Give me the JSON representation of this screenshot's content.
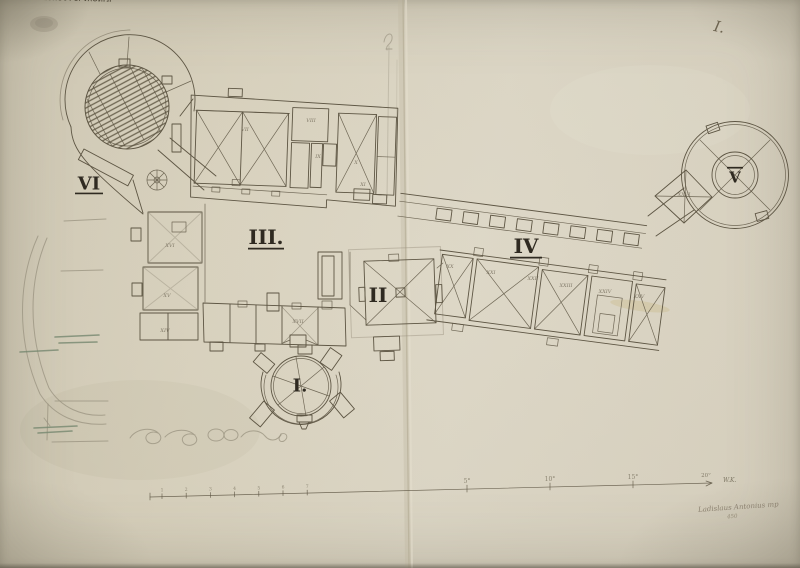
{
  "document": {
    "stamp_text": "HRVATSKOJ I SLAVONIJI",
    "plate_number": "I.",
    "signature": "Ladislaus Antonius mp",
    "signature_note": "450"
  },
  "plan": {
    "section_labels": [
      {
        "id": "I",
        "label": "I.",
        "x": 300,
        "y": 385,
        "size": 18,
        "bar": "none"
      },
      {
        "id": "II",
        "label": "II",
        "x": 378,
        "y": 295,
        "size": 20,
        "bar": "none"
      },
      {
        "id": "III",
        "label": "III.",
        "x": 266,
        "y": 237,
        "size": 20,
        "bar": "under",
        "bar_w": 18
      },
      {
        "id": "IV",
        "label": "IV",
        "x": 526,
        "y": 246,
        "size": 20,
        "bar": "under",
        "bar_w": 16
      },
      {
        "id": "V",
        "label": "V",
        "x": 735,
        "y": 177,
        "size": 15,
        "bar": "over",
        "bar_w": 8
      },
      {
        "id": "VI",
        "label": "VI",
        "x": 89,
        "y": 183,
        "size": 18,
        "bar": "under",
        "bar_w": 14
      }
    ],
    "room_labels": [
      {
        "label": "VII",
        "x": 245,
        "y": 131
      },
      {
        "label": "VIII",
        "x": 311,
        "y": 122
      },
      {
        "label": "IX",
        "x": 318,
        "y": 158
      },
      {
        "label": "X",
        "x": 356,
        "y": 164
      },
      {
        "label": "XI",
        "x": 363,
        "y": 186
      },
      {
        "label": "XIV",
        "x": 165,
        "y": 332
      },
      {
        "label": "XV",
        "x": 167,
        "y": 297
      },
      {
        "label": "XVI",
        "x": 170,
        "y": 247
      },
      {
        "label": "XVII",
        "x": 298,
        "y": 323
      },
      {
        "label": "XX",
        "x": 450,
        "y": 268
      },
      {
        "label": "XXI",
        "x": 491,
        "y": 274
      },
      {
        "label": "XXII",
        "x": 533,
        "y": 280
      },
      {
        "label": "XXIII",
        "x": 566,
        "y": 287
      },
      {
        "label": "XXIV",
        "x": 605,
        "y": 293
      },
      {
        "label": "XXV",
        "x": 639,
        "y": 298
      },
      {
        "label": "XXVI",
        "x": 684,
        "y": 196
      }
    ]
  },
  "scale_bar": {
    "minor_labels": [
      "1",
      "2",
      "3",
      "4",
      "5",
      "6",
      "7"
    ],
    "major_labels": [
      "5°",
      "10°",
      "15°"
    ],
    "end_label": "20°",
    "unit_label": "W.K."
  },
  "colors": {
    "paper": "#d6cfbd",
    "ink": "#5d5543",
    "pencil": "#98917f",
    "green_pencil": "#75876f",
    "label_ink": "#2f2a21",
    "stamp_ink": "#4f4938"
  }
}
